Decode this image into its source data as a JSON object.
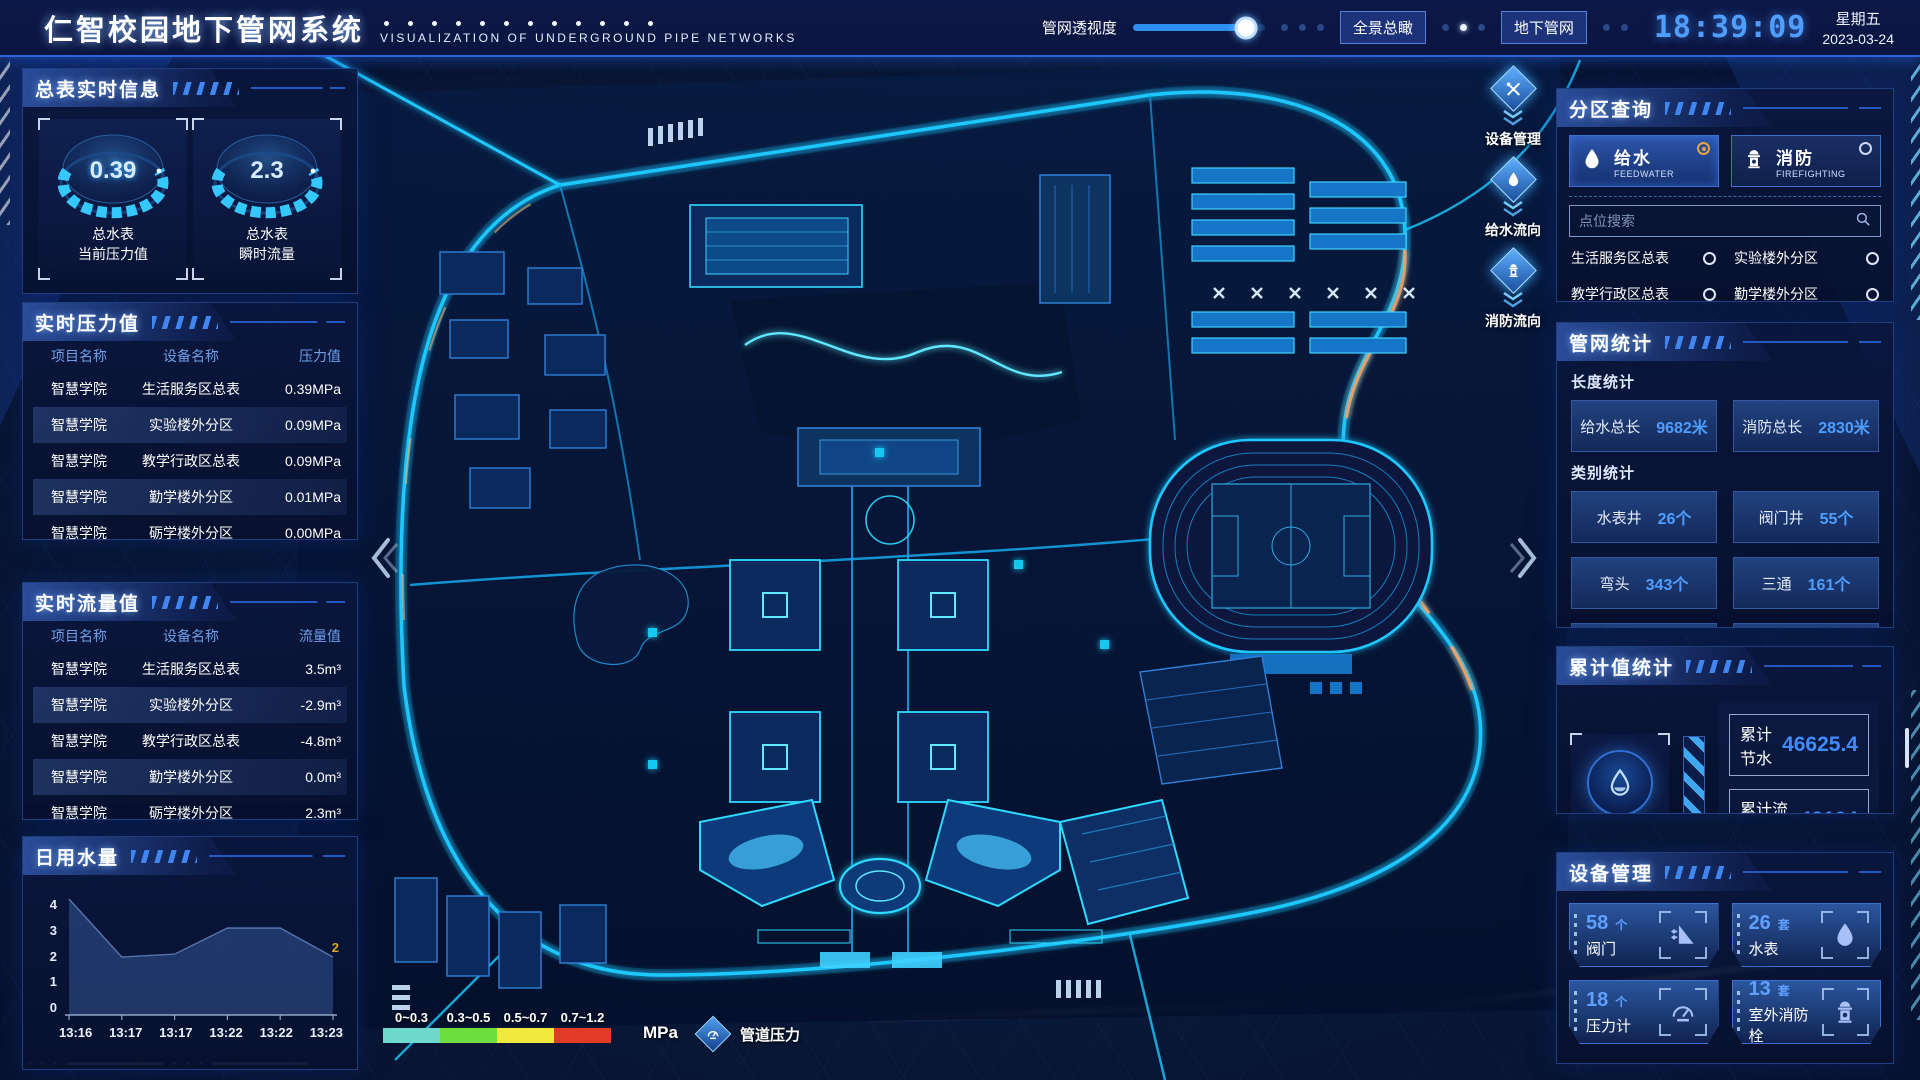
{
  "header": {
    "title": "仁智校园地下管网系统",
    "subtitle": "VISUALIZATION OF UNDERGROUND PIPE NETWORKS",
    "transparency_label": "管网透视度",
    "transparency_percent": 86,
    "overview_button": "全景总瞰",
    "underground_button": "地下管网",
    "time": "18:39:09",
    "weekday": "星期五",
    "date": "2023-03-24"
  },
  "left": {
    "master": {
      "title": "总表实时信息",
      "gauges": [
        {
          "value": "0.39",
          "line1": "总水表",
          "line2": "当前压力值"
        },
        {
          "value": "2.3",
          "line1": "总水表",
          "line2": "瞬时流量"
        }
      ]
    },
    "pressure": {
      "title": "实时压力值",
      "headers": [
        "项目名称",
        "设备名称",
        "压力值"
      ],
      "rows": [
        [
          "智慧学院",
          "生活服务区总表",
          "0.39MPa"
        ],
        [
          "智慧学院",
          "实验楼外分区",
          "0.09MPa"
        ],
        [
          "智慧学院",
          "教学行政区总表",
          "0.09MPa"
        ],
        [
          "智慧学院",
          "勤学楼外分区",
          "0.01MPa"
        ],
        [
          "智慧学院",
          "砺学楼外分区",
          "0.00MPa"
        ]
      ]
    },
    "flow": {
      "title": "实时流量值",
      "headers": [
        "项目名称",
        "设备名称",
        "流量值"
      ],
      "rows": [
        [
          "智慧学院",
          "生活服务区总表",
          "3.5m³"
        ],
        [
          "智慧学院",
          "实验楼外分区",
          "-2.9m³"
        ],
        [
          "智慧学院",
          "教学行政区总表",
          "-4.8m³"
        ],
        [
          "智慧学院",
          "勤学楼外分区",
          "0.0m³"
        ],
        [
          "智慧学院",
          "砺学楼外分区",
          "2.3m³"
        ]
      ]
    },
    "daily": {
      "title": "日用水量"
    }
  },
  "chart_data": {
    "type": "area",
    "title": "日用水量",
    "x": [
      "13:16",
      "13:17",
      "13:17",
      "13:22",
      "13:22",
      "13:23"
    ],
    "values": [
      4,
      2,
      2.1,
      3,
      3,
      2
    ],
    "yticks": [
      0,
      1,
      2,
      3,
      4
    ],
    "ylim": [
      0,
      4
    ],
    "end_label": "2",
    "area_color": "rgba(72,112,190,0.38)",
    "line_color": "rgba(140,178,245,0.55)",
    "label_color": "#d9a62e",
    "legend_position": "none",
    "grid": false
  },
  "right": {
    "zone": {
      "title": "分区查询",
      "tabs": [
        {
          "label": "给水",
          "sub": "FEEDWATER",
          "selected": true,
          "icon": "water-drop-icon"
        },
        {
          "label": "消防",
          "sub": "FIREFIGHTING",
          "selected": false,
          "icon": "fire-hydrant-icon"
        }
      ],
      "search_placeholder": "点位搜索",
      "items": [
        "生活服务区总表",
        "实验楼外分区",
        "教学行政区总表",
        "勤学楼外分区",
        "砺学楼外分区",
        "宿舍区泵房"
      ]
    },
    "pipestats": {
      "title": "管网统计",
      "length_title": "长度统计",
      "length": [
        {
          "label": "给水总长",
          "value": "9682米"
        },
        {
          "label": "消防总长",
          "value": "2830米"
        }
      ],
      "category_title": "类别统计",
      "categories": [
        {
          "label": "水表井",
          "value": "26个"
        },
        {
          "label": "阀门井",
          "value": "55个"
        },
        {
          "label": "弯头",
          "value": "343个"
        },
        {
          "label": "三通",
          "value": "161个"
        }
      ]
    },
    "cumulative": {
      "title": "累计值统计",
      "icon": "water-drop-icon",
      "rows": [
        {
          "label": "累计节水",
          "value": "46625.4"
        },
        {
          "label": "累计流量",
          "value": "42104"
        }
      ]
    },
    "devices": {
      "title": "设备管理",
      "cards": [
        {
          "count": "58",
          "unit": "个",
          "label": "阀门",
          "icon": "valve-icon"
        },
        {
          "count": "26",
          "unit": "套",
          "label": "水表",
          "icon": "water-drop-icon"
        },
        {
          "count": "18",
          "unit": "个",
          "label": "压力计",
          "icon": "pressure-gauge-icon"
        },
        {
          "count": "13",
          "unit": "套",
          "label": "室外消防栓",
          "icon": "fire-hydrant-icon"
        }
      ]
    }
  },
  "map": {
    "tools": [
      {
        "label": "设备管理",
        "icon": "tools-wrench-icon"
      },
      {
        "label": "给水流向",
        "icon": "water-drop-icon"
      },
      {
        "label": "消防流向",
        "icon": "fire-hydrant-icon"
      }
    ],
    "legend": {
      "ranges": [
        "0~0.3",
        "0.3~0.5",
        "0.5~0.7",
        "0.7~1.2"
      ],
      "colors": [
        "#6fd8cf",
        "#6ede3e",
        "#f2e93e",
        "#e23b26"
      ],
      "unit": "MPa",
      "label": "管道压力",
      "label_icon": "pressure-gauge-icon"
    }
  },
  "colors": {
    "accent_blue": "#2f7ef0",
    "neon_cyan": "#22d3ff",
    "value_blue": "#4f9eff",
    "highlight_orange": "#e8a33d",
    "clock_blue": "#4f9eff"
  }
}
